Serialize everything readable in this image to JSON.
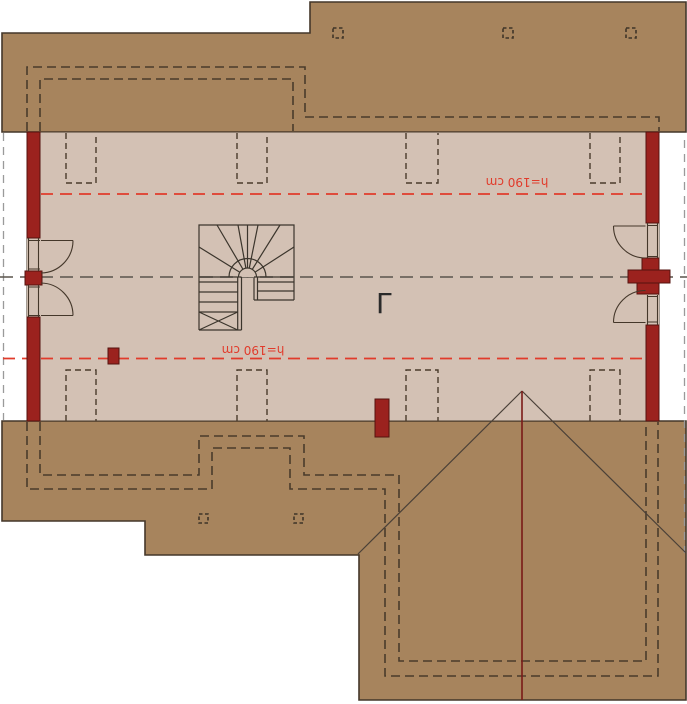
{
  "plan": {
    "kind": "attic-floor-plan",
    "height_lines": [
      {
        "label": "h=190 cm",
        "position": "upper",
        "rotated_180": true
      },
      {
        "label": "h=190 cm",
        "position": "lower",
        "rotated_180": true
      }
    ],
    "section_mark_glyph": "Γ"
  },
  "colors": {
    "background": "#ffffff",
    "roof": "#a7845d",
    "floor": "#d3c1b4",
    "masonry_red": "#9b221e",
    "height_line_red": "#e13b2b",
    "outline_dark": "#44372a",
    "ridge_red": "#7a1a17"
  }
}
